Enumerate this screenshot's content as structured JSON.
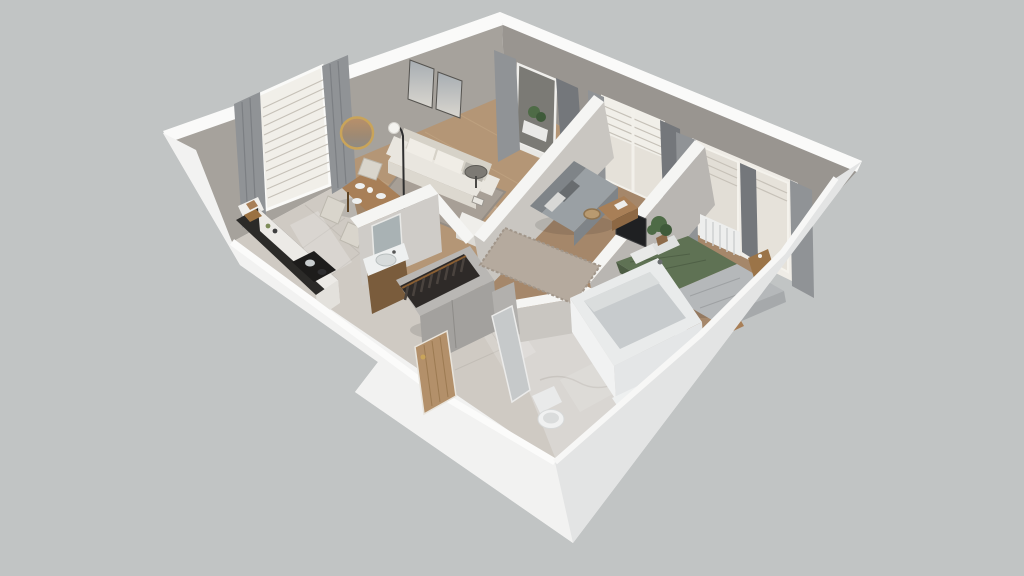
{
  "scene": {
    "type": "3d-apartment-floorplan-render",
    "view": "isometric-dollhouse-cutaway",
    "rooms": [
      {
        "name": "living-dining-room",
        "floor": "wood",
        "furniture": [
          "cream-sofa",
          "back-cushions",
          "coffee-table",
          "area-rug",
          "floor-lamp",
          "wall-art-frames",
          "round-mirror",
          "dining-table",
          "dining-chairs",
          "place-settings",
          "console-table",
          "floor-books",
          "balcony-door",
          "balcony-plant",
          "window-with-blinds",
          "gray-curtains"
        ]
      },
      {
        "name": "kitchen",
        "floor": "tile",
        "furniture": [
          "black-countertop",
          "cooktop",
          "cooking-pots",
          "cutting-board",
          "upper-cabinet"
        ]
      },
      {
        "name": "wc-room",
        "floor": "tile",
        "furniture": [
          "wood-vanity",
          "sink-basin",
          "vanity-mirror"
        ]
      },
      {
        "name": "hallway",
        "floor": "tile",
        "furniture": [
          "open-wardrobe",
          "hanging-clothes",
          "tall-cabinet",
          "entry-door"
        ]
      },
      {
        "name": "office-room",
        "floor": "wood",
        "furniture": [
          "gray-sofa",
          "throw-pillows",
          "shag-rug",
          "desk",
          "wicker-stool",
          "tv-screen",
          "window-with-curtains"
        ]
      },
      {
        "name": "bedroom",
        "floor": "wood",
        "furniture": [
          "double-bed",
          "green-duvet",
          "gray-throw",
          "pillows",
          "nightstand",
          "foot-bench",
          "potted-plant",
          "radiator",
          "double-window",
          "gray-curtains"
        ]
      },
      {
        "name": "bathroom",
        "floor": "marble",
        "furniture": [
          "bathtub",
          "toilet",
          "washing-machine",
          "open-glass-door"
        ]
      }
    ]
  },
  "palette": {
    "background": "#c1c4c4",
    "outerWall": "#f2f2f1",
    "outerWallShade": "#e3e4e4",
    "wallTopHighlight": "#fafaf9",
    "interiorWallLight": "#a6a29c",
    "interiorWallMid": "#999590",
    "partitionFace": "#c9c6c1",
    "woodFloorLight": "#b49676",
    "woodFloorDark": "#a5876a",
    "tileFloor": "#cfcac3",
    "marbleFloor": "#d9d6d2",
    "curtain": "#909396",
    "curtainDark": "#74777b",
    "sofaCream": "#e9e6df",
    "sofaCreamShade": "#d6d2c8",
    "sofaGray": "#9aa0a4",
    "sofaGrayDark": "#7f8488",
    "rugLiving": "#a79f96",
    "rugOffice": "#b5aa9e",
    "bedGreen": "#5f7254",
    "bedGreenDark": "#4c5c43",
    "bedGray": "#b5b8ba",
    "woodFurniture": "#a87f57",
    "woodFurnitureDark": "#8d6844",
    "counterBlack": "#2b2a28",
    "doorWood": "#b3906a",
    "plantGreen": "#4e6b46",
    "tvBlack": "#1f2022",
    "fixtureWhite": "#eef0f0",
    "goldAccent": "#c9a45a"
  }
}
